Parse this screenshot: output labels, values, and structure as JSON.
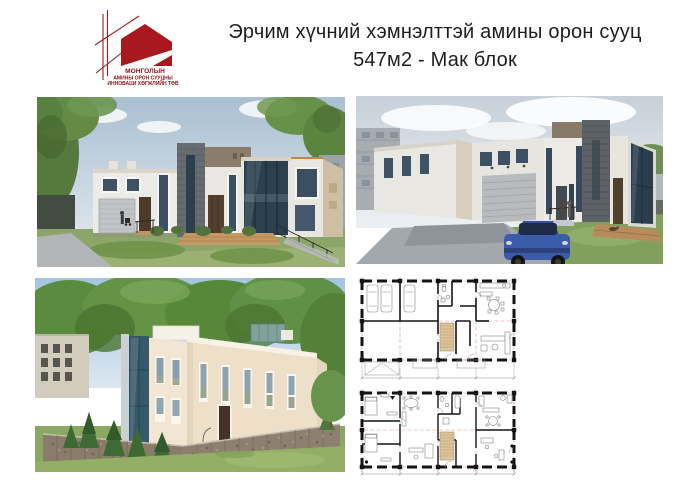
{
  "header": {
    "title_line1": "Эрчим хүчний хэмнэлттэй амины орон сууц",
    "title_line2": "547м2 - Мак блок"
  },
  "logo": {
    "org_name_line1": "МОНГОЛЫН",
    "org_name_line2": "АМИНЫ ОРОН СУУЦНЫ",
    "org_name_line3": "ИННОВАЦИ ХӨГЖЛИЙН ТӨВ"
  },
  "palette": {
    "logo_red": "#9e1b1e",
    "title_text": "#1f1f1f",
    "sky_blue": "#a9c2d6",
    "sky_overcast": "#c7d0d8",
    "wall_white": "#eae8e3",
    "wall_cream": "#efe2cf",
    "stone_dark": "#64696d",
    "glass_dark": "#2c4150",
    "grass_green": "#8aa65e",
    "deck_wood": "#c49862",
    "car_blue": "#3b5ca8",
    "plan_wall": "#141414",
    "plan_axis_red": "#da9089",
    "plan_stairs_tan": "#dcc49d"
  }
}
